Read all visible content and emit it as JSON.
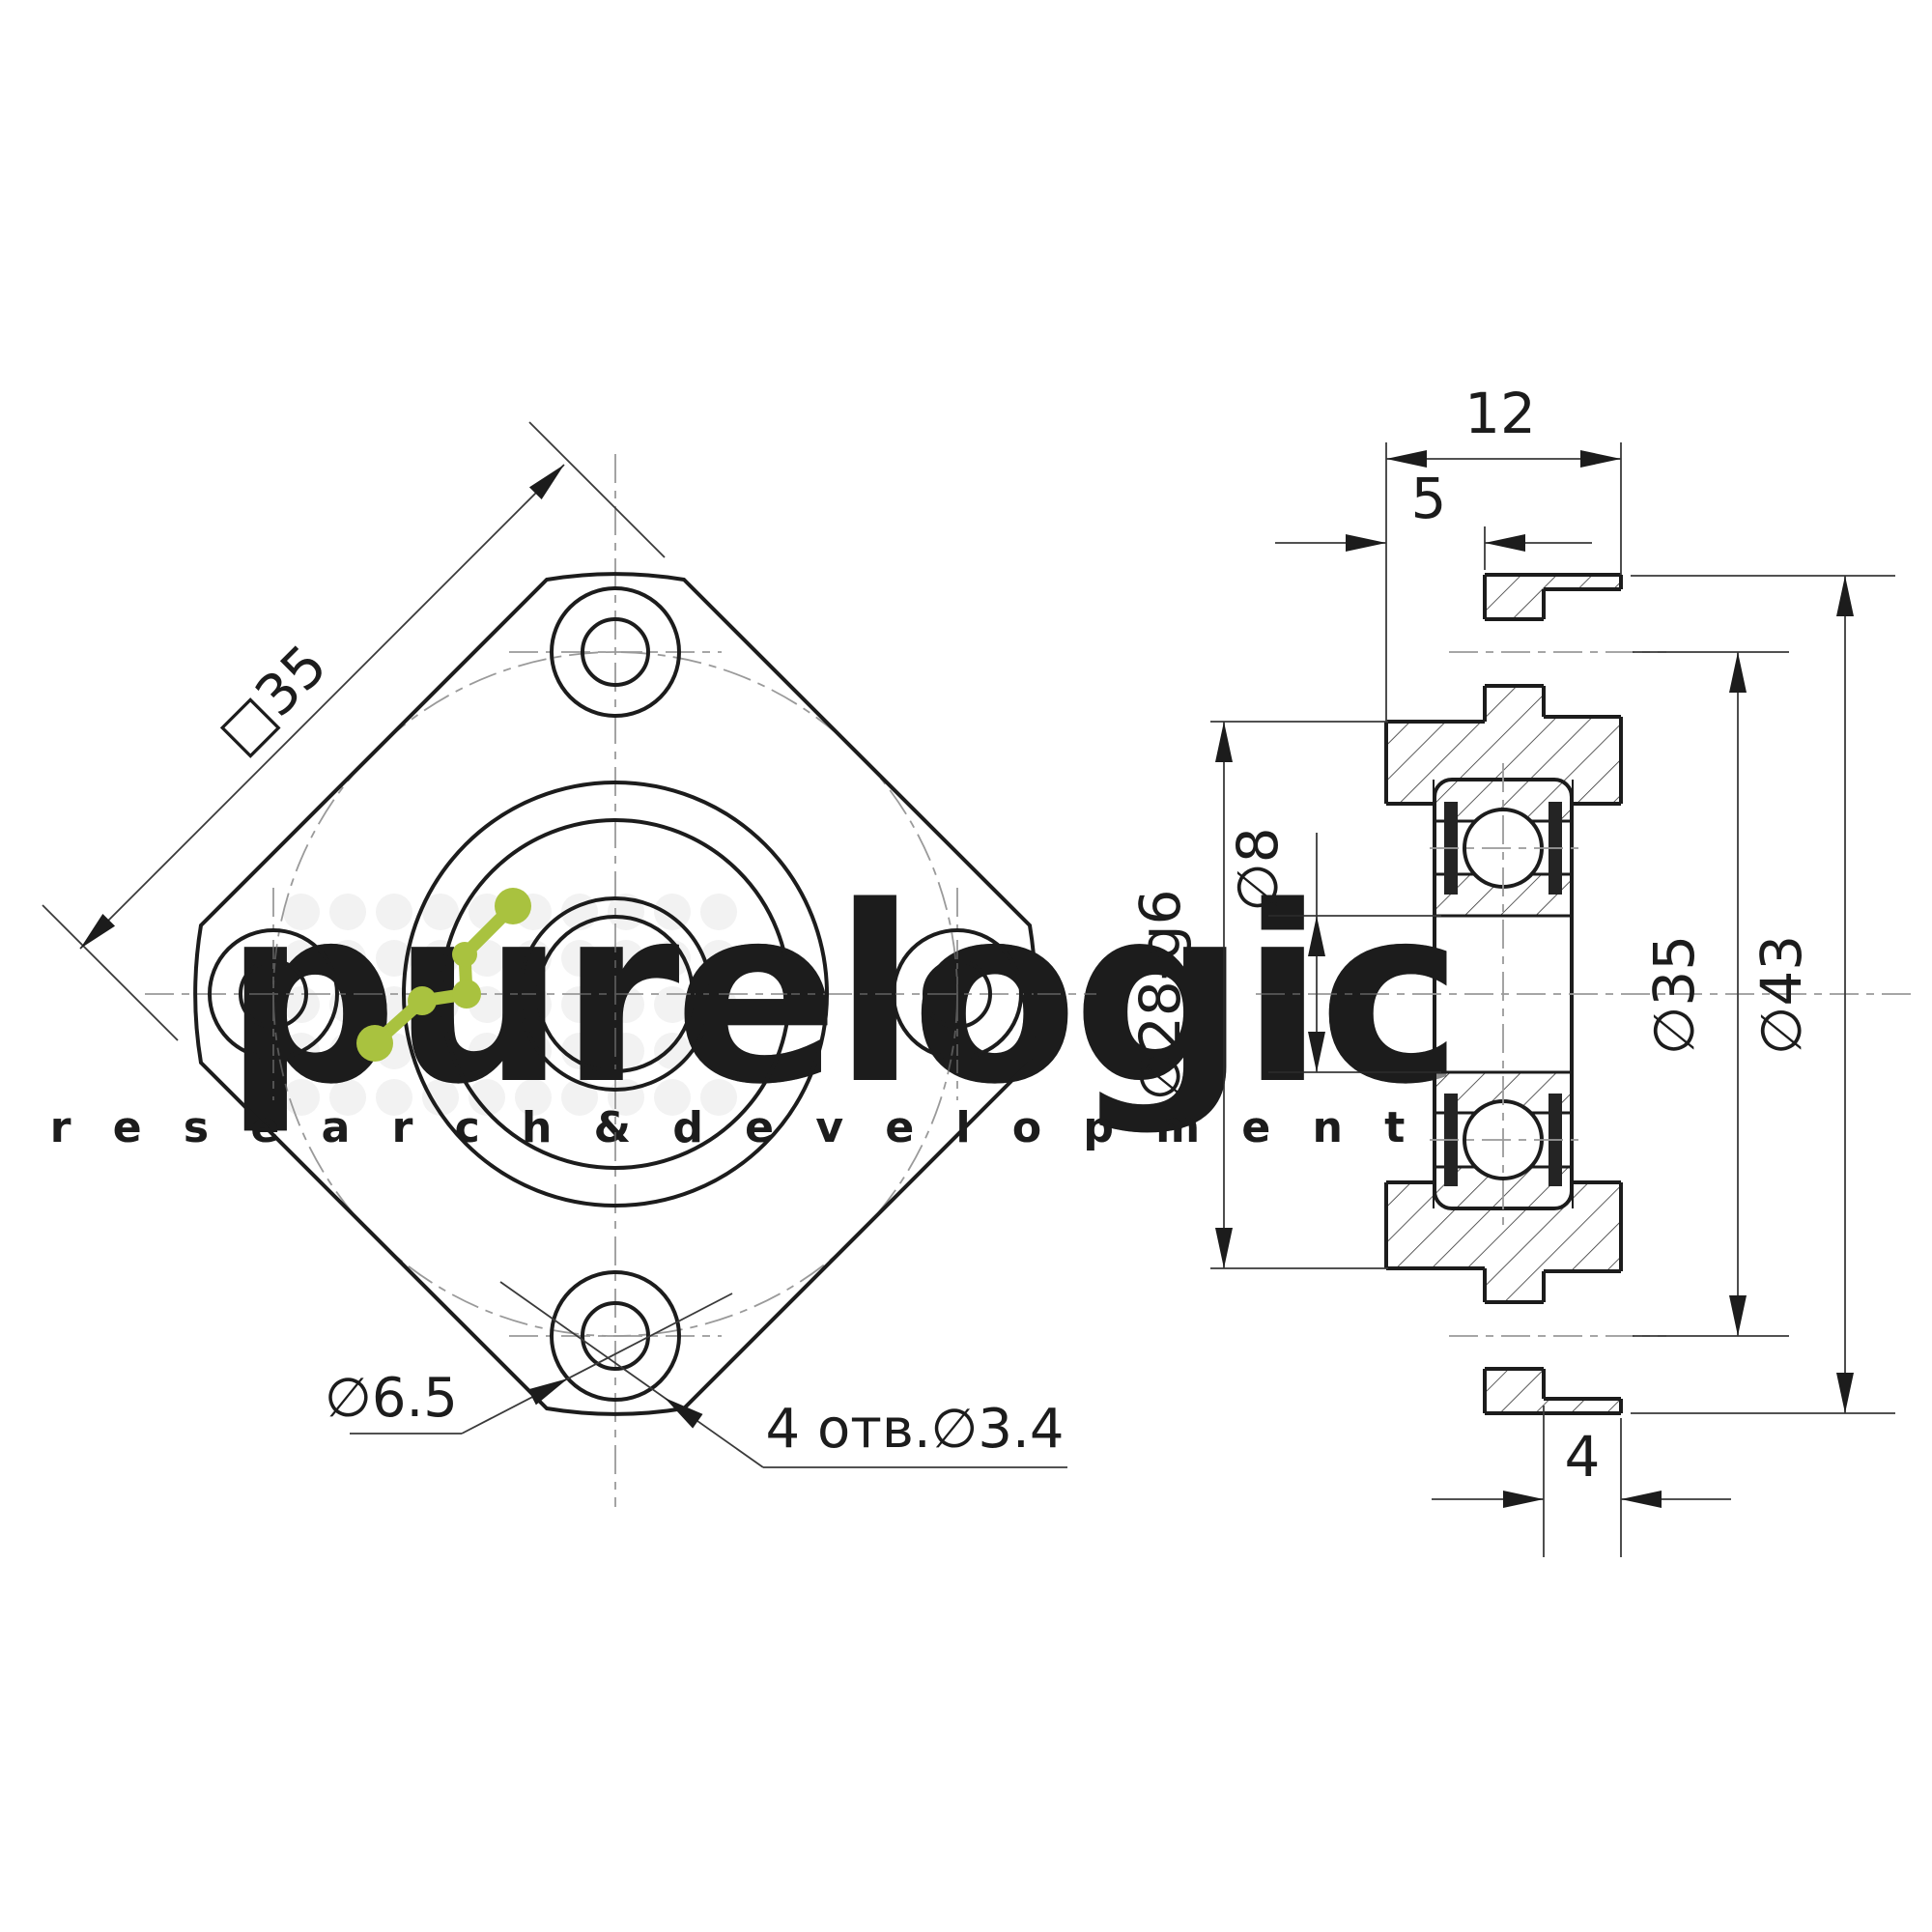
{
  "drawing": {
    "front_view": {
      "square_dim": "□35",
      "counterbore_dia": "∅6.5",
      "holes_note": "4 отв.∅3.4"
    },
    "section_view": {
      "total_width": "12",
      "spigot_length": "5",
      "spigot_dia": "∅28-g6",
      "bore_dia": "∅8",
      "bolt_circle_dia": "∅35",
      "flange_dia": "∅43",
      "counterbore_depth": "4"
    },
    "watermark": {
      "brand": "purelogic",
      "tagline": "r e s e a r c h   &   d e v e l o p m e n t",
      "accent_color": "#a9c23f"
    },
    "colors": {
      "line": "#1c1c1c",
      "thin_line": "#3a3a3a",
      "centerline": "#9a9a9a",
      "watermark_gray": "#e9e9e9"
    }
  }
}
